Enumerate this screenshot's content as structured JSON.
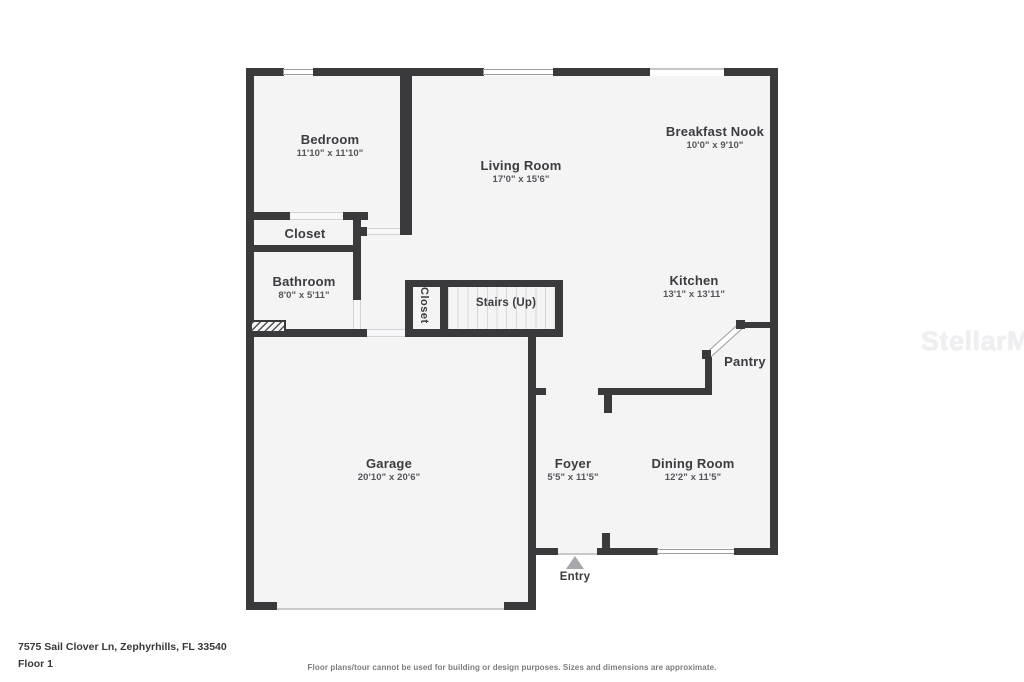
{
  "rooms": {
    "bedroom": {
      "name": "Bedroom",
      "dims": "11'10\" x 11'10\""
    },
    "living_room": {
      "name": "Living Room",
      "dims": "17'0\" x 15'6\""
    },
    "breakfast_nook": {
      "name": "Breakfast Nook",
      "dims": "10'0\" x 9'10\""
    },
    "closet_bedroom": {
      "name": "Closet"
    },
    "bathroom": {
      "name": "Bathroom",
      "dims": "8'0\" x 5'11\""
    },
    "kitchen": {
      "name": "Kitchen",
      "dims": "13'1\" x 13'11\""
    },
    "closet_stairs": {
      "name": "Closet"
    },
    "stairs": {
      "name": "Stairs (Up)"
    },
    "pantry": {
      "name": "Pantry"
    },
    "garage": {
      "name": "Garage",
      "dims": "20'10\" x 20'6\""
    },
    "foyer": {
      "name": "Foyer",
      "dims": "5'5\" x 11'5\""
    },
    "dining_room": {
      "name": "Dining Room",
      "dims": "12'2\" x 11'5\""
    },
    "entry": {
      "name": "Entry"
    }
  },
  "watermark": "StellarMLS",
  "footer": {
    "address": "7575 Sail Clover Ln, Zephyrhills, FL 33540",
    "floor": "Floor 1",
    "disclaimer": "Floor plans/tour cannot be used for building or design purposes. Sizes and dimensions are approximate."
  },
  "colors": {
    "wall": "#3a3a3c",
    "floor_fill": "#f4f4f5",
    "entry_arrow": "#a7a7ac"
  }
}
